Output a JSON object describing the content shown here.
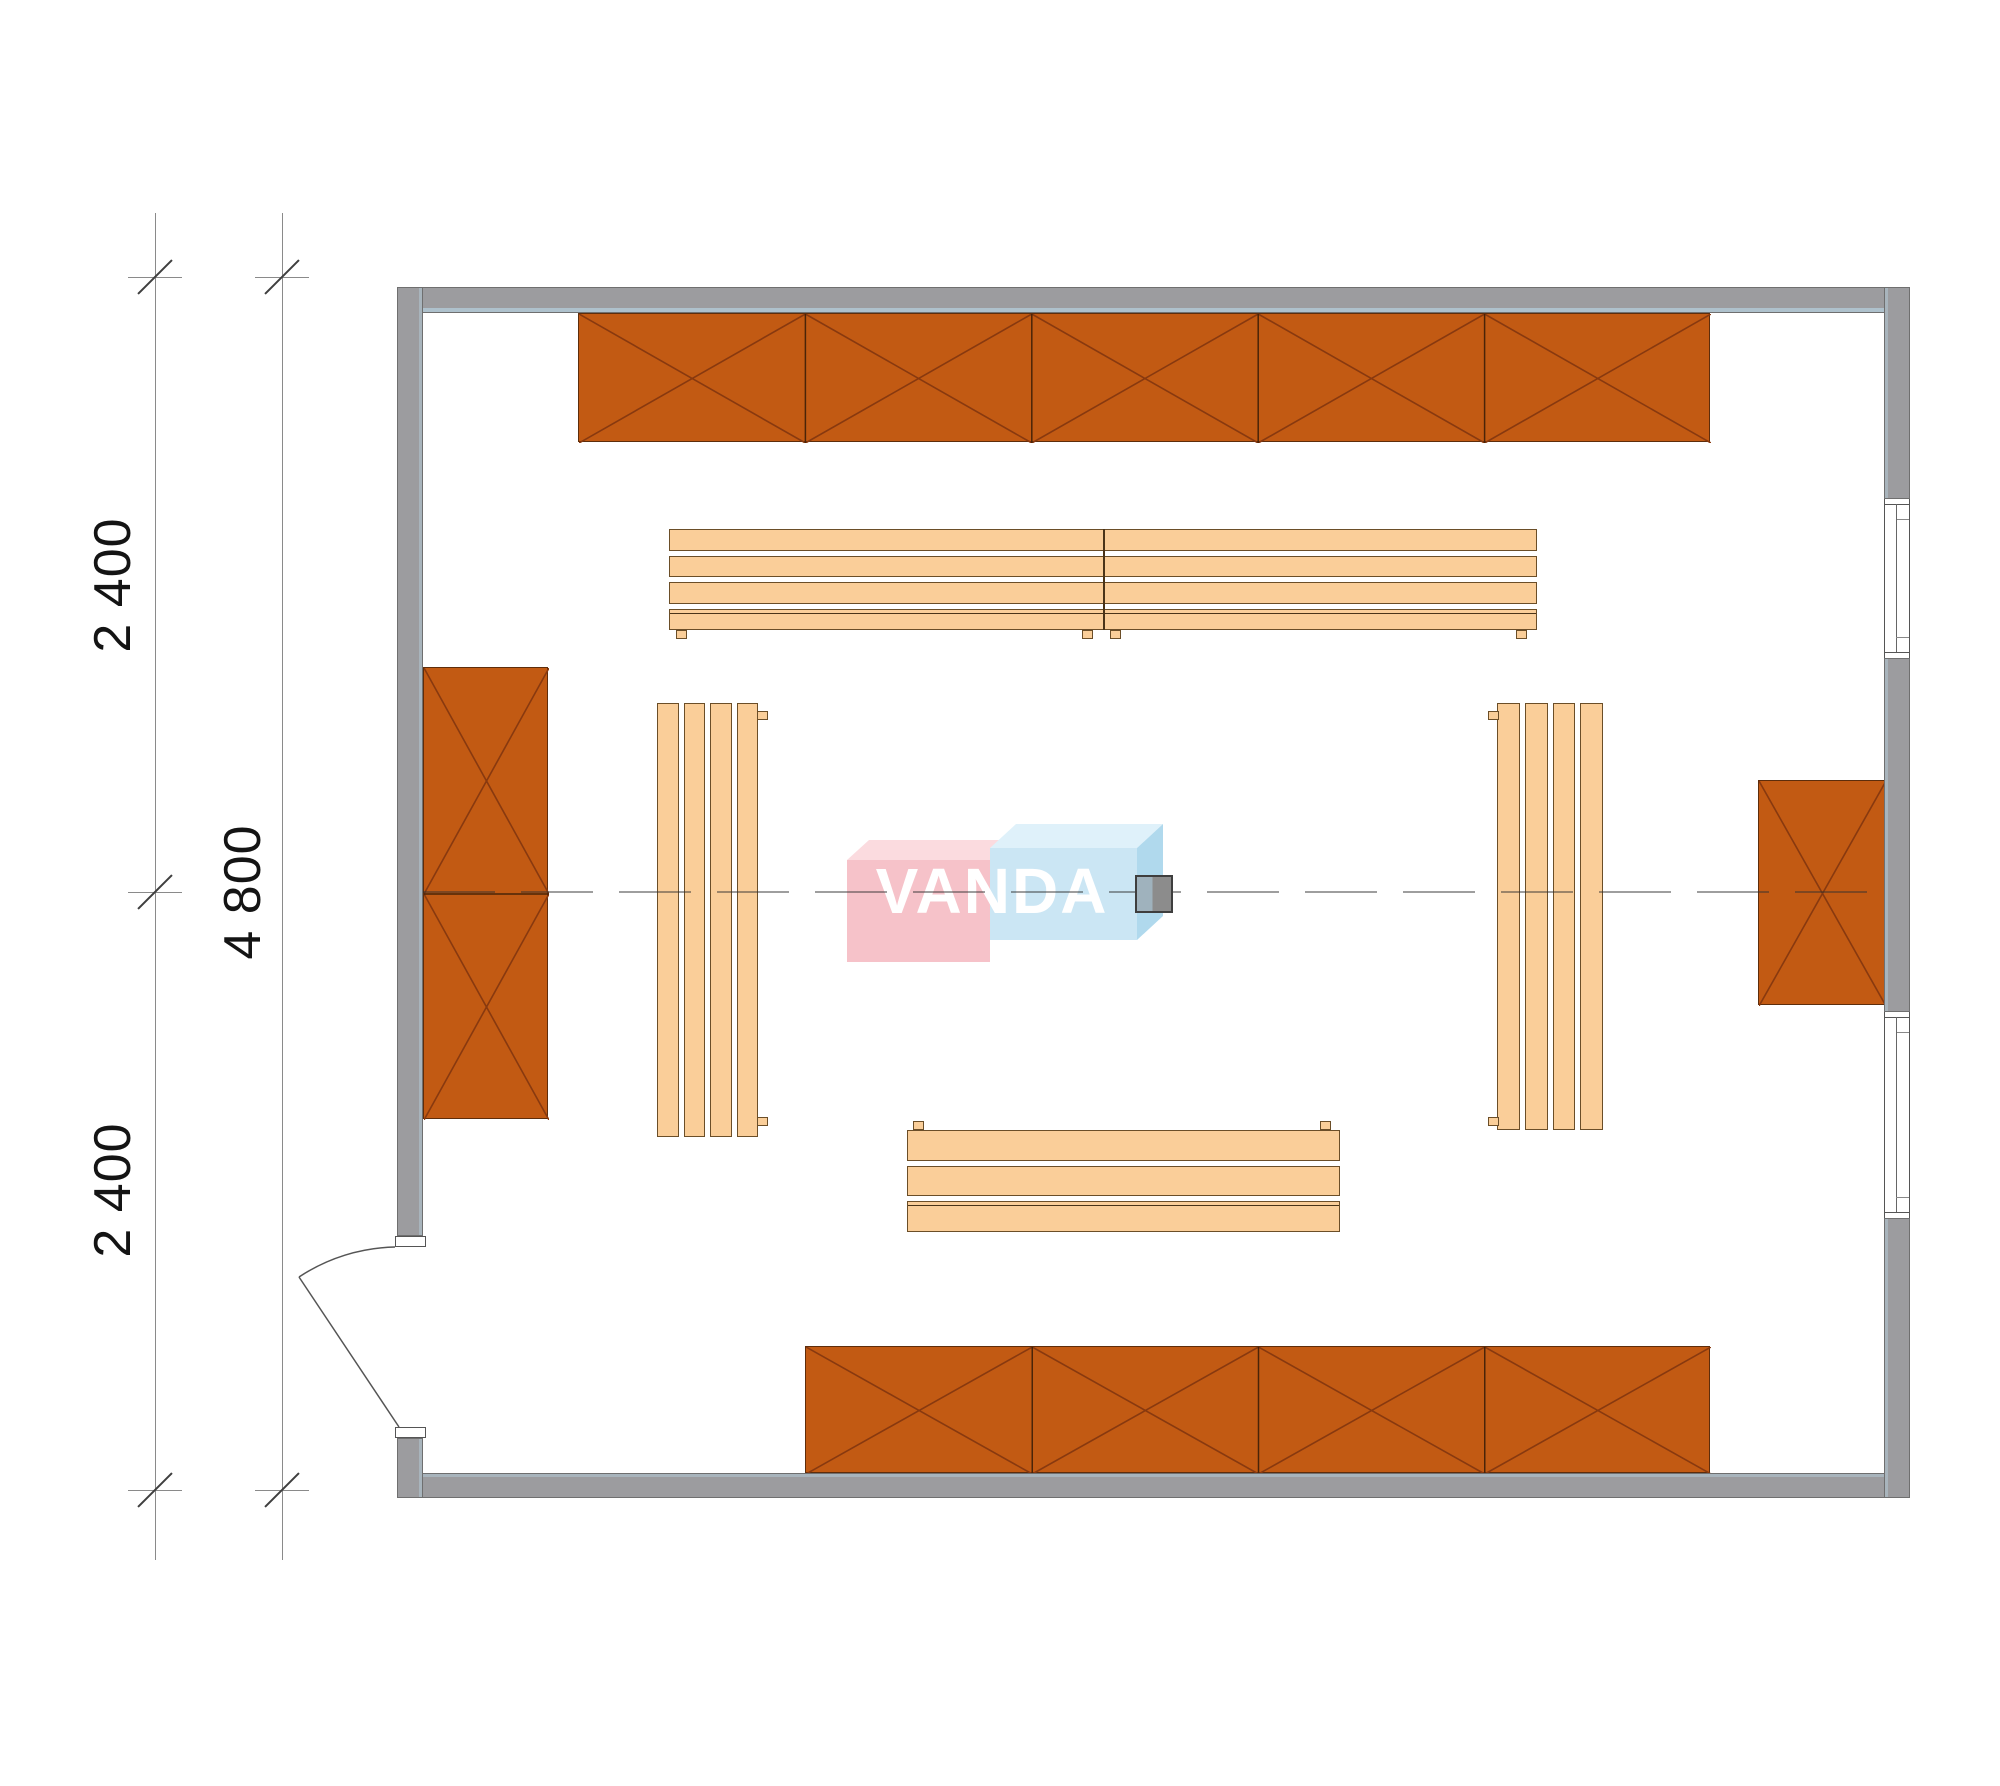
{
  "plan": {
    "title": "room-floor-plan",
    "watermark_text": "VANDA",
    "dim_top": "2 400",
    "dim_middle": "4 800",
    "dim_bottom": "2 400"
  },
  "colors": {
    "wall_fill": "#9c9c9f",
    "wall_line": "#6f6f6f",
    "wall_inner_highlight": "#b2c8d3",
    "shelf_fill": "#c25a13",
    "shelf_cross_line": "#88390f",
    "shelf_border": "#5e2d0b",
    "bench_fill": "#face99",
    "bench_border": "#6b4e28",
    "centerline": "#3c3c3c",
    "dimension_line": "#8a8a8a",
    "dimension_text": "#141414",
    "watermark_pink": "#f6bec5",
    "watermark_pink_top": "#fbd9dd",
    "watermark_blue": "#c8e5f4",
    "watermark_blue_top": "#ddf1fa",
    "watermark_blue_side": "#abd7ec",
    "stove_left": "#9fb2bd",
    "stove_right": "#8c8c8c"
  },
  "furniture": {
    "shelves": [
      {
        "name": "shelf-top-wall",
        "x": 578,
        "y": 313,
        "w": 1132,
        "h": 129,
        "cols": 5,
        "rows": 1
      },
      {
        "name": "shelf-bottom-wall",
        "x": 805,
        "y": 1346,
        "w": 905,
        "h": 127,
        "cols": 4,
        "rows": 1
      },
      {
        "name": "shelf-left-wall",
        "x": 423,
        "y": 667,
        "w": 125,
        "h": 452,
        "cols": 1,
        "rows": 2
      },
      {
        "name": "shelf-right-wall",
        "x": 1758,
        "y": 780,
        "w": 127,
        "h": 225,
        "cols": 1,
        "rows": 1
      }
    ],
    "benches": [
      {
        "name": "bench-top",
        "x": 669,
        "y": 529,
        "w": 868,
        "h": 101,
        "dir": "h",
        "slats": 4,
        "units": 2,
        "feet": [
          [
            676,
            630
          ],
          [
            1082,
            630
          ],
          [
            1110,
            630
          ],
          [
            1516,
            630
          ]
        ]
      },
      {
        "name": "bench-bottom",
        "x": 907,
        "y": 1130,
        "w": 433,
        "h": 102,
        "dir": "h",
        "slats": 3,
        "units": 1,
        "feet": [
          [
            913,
            1121
          ],
          [
            1320,
            1121
          ]
        ]
      },
      {
        "name": "bench-left",
        "x": 657,
        "y": 703,
        "w": 101,
        "h": 434,
        "dir": "v",
        "slats": 4,
        "units": 1,
        "feet": [
          [
            757,
            711
          ],
          [
            757,
            1117
          ]
        ]
      },
      {
        "name": "bench-right",
        "x": 1497,
        "y": 703,
        "w": 106,
        "h": 427,
        "dir": "v",
        "slats": 4,
        "units": 1,
        "feet": [
          [
            1488,
            711
          ],
          [
            1488,
            1117
          ]
        ]
      }
    ],
    "stove": {
      "name": "stove",
      "x": 1135,
      "y": 875,
      "w": 38,
      "h": 38
    }
  },
  "geometry": {
    "room_inner": {
      "left": 423,
      "top": 312,
      "right": 1884,
      "bottom": 1473
    },
    "centerline_y": 892,
    "windows": [
      {
        "name": "window-upper-right",
        "top": 499,
        "h": 159
      },
      {
        "name": "window-lower-right",
        "top": 1012,
        "h": 206
      }
    ],
    "door": {
      "hinge": [
        399,
        1427
      ],
      "leaf_end": [
        299,
        1277
      ],
      "arc_start": [
        395,
        1247
      ],
      "radius": 180
    }
  }
}
